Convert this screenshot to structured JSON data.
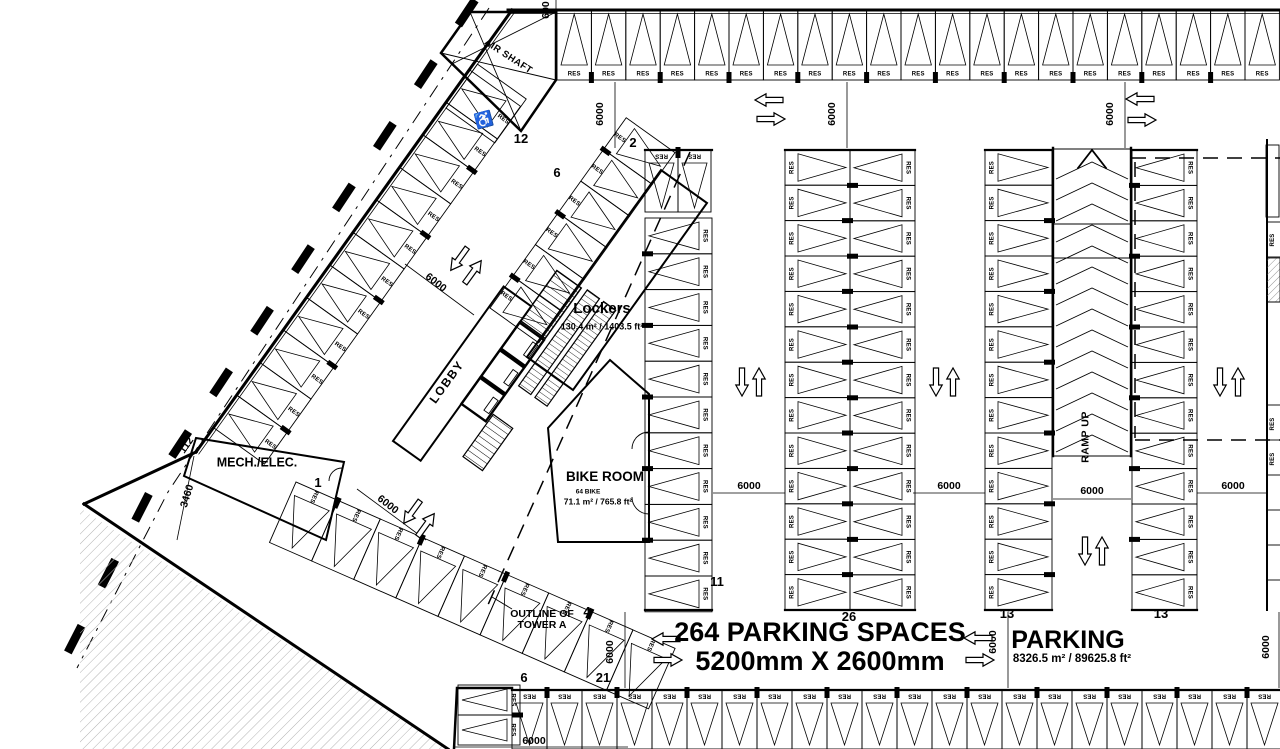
{
  "plan": {
    "labels": {
      "title_line1": "264 PARKING SPACES",
      "title_line2": "5200mm X 2600mm",
      "parking": "PARKING",
      "parking_area": "8326.5 m² / 89625.8 ft²",
      "lobby": "LOBBY",
      "air_shaft": "AIR SHAFT",
      "mech_elec": "MECH./ELEC.",
      "bike_room": "BIKE ROOM",
      "bike_count": "64 BIKE",
      "bike_area": "71.1 m² / 765.8 ft²",
      "lockers": "Lockers",
      "lockers_area": "130.4 m² / 1403.5 ft²",
      "ramp_up": "RAMP UP",
      "outline_line1": "OUTLINE OF",
      "outline_line2": "TOWER A",
      "handicap_icon": "♿"
    },
    "stall_label": "RES",
    "colors": {
      "line": "#000000",
      "background": "#ffffff",
      "hatch": "#b3b3b3"
    },
    "counts": [
      {
        "t": "12",
        "x": 521,
        "y": 143
      },
      {
        "t": "6",
        "x": 557,
        "y": 177
      },
      {
        "t": "2",
        "x": 633,
        "y": 147
      },
      {
        "t": "1",
        "x": 318,
        "y": 487
      },
      {
        "t": "11",
        "x": 717,
        "y": 586
      },
      {
        "t": "26",
        "x": 849,
        "y": 621
      },
      {
        "t": "13",
        "x": 1007,
        "y": 618
      },
      {
        "t": "13",
        "x": 1161,
        "y": 618
      },
      {
        "t": "4",
        "x": 587,
        "y": 616
      },
      {
        "t": "21",
        "x": 603,
        "y": 682
      },
      {
        "t": "6",
        "x": 524,
        "y": 682
      }
    ],
    "dimensions": [
      {
        "t": "600",
        "x": 549,
        "y": 10,
        "r": -90
      },
      {
        "t": "6000",
        "x": 603,
        "y": 114,
        "r": -90
      },
      {
        "t": "6000",
        "x": 835,
        "y": 114,
        "r": -90
      },
      {
        "t": "6000",
        "x": 1113,
        "y": 114,
        "r": -90
      },
      {
        "t": "6000",
        "x": 749,
        "y": 489,
        "r": 0
      },
      {
        "t": "6000",
        "x": 949,
        "y": 489,
        "r": 0
      },
      {
        "t": "6000",
        "x": 1092,
        "y": 494,
        "r": 0
      },
      {
        "t": "6000",
        "x": 1233,
        "y": 489,
        "r": 0
      },
      {
        "t": "6000",
        "x": 613,
        "y": 652,
        "r": -90
      },
      {
        "t": "6000",
        "x": 996,
        "y": 642,
        "r": -90
      },
      {
        "t": "6000",
        "x": 1269,
        "y": 647,
        "r": -90
      },
      {
        "t": "6000",
        "x": 534,
        "y": 744,
        "r": 0
      },
      {
        "t": "6000",
        "x": 434,
        "y": 285,
        "r": 38
      },
      {
        "t": "6000",
        "x": 386,
        "y": 507,
        "r": 38
      },
      {
        "t": "3460",
        "x": 190,
        "y": 497,
        "r": -73
      },
      {
        "t": "112",
        "x": 189,
        "y": 447,
        "r": -55
      }
    ],
    "stall_groups": [
      {
        "id": "top-row",
        "x": 557,
        "y": 10,
        "rot": 0,
        "n": 21,
        "w": 34.4,
        "d": 70,
        "res": "far",
        "tr": 0,
        "blk": "res"
      },
      {
        "id": "bottom-row",
        "x": 512,
        "y": 690,
        "rot": 0,
        "n": 22,
        "w": 35,
        "d": 59,
        "res": "near",
        "tr": 180,
        "blk": "res"
      },
      {
        "id": "bottom-left-pair",
        "x": 520,
        "y": 685,
        "rot": 90,
        "n": 2,
        "w": 30,
        "d": 62,
        "res": "near",
        "tr": 0,
        "blk": "res"
      },
      {
        "id": "colA-top-pair",
        "x": 645,
        "y": 150,
        "rot": 0,
        "n": 2,
        "w": 33,
        "d": 62,
        "res": "near",
        "tr": 180,
        "blk": "res"
      },
      {
        "id": "colA",
        "x": 712,
        "y": 218,
        "rot": 90,
        "n": 11,
        "w": 35.8,
        "d": 67,
        "res": "near",
        "tr": 0,
        "blk": "back"
      },
      {
        "id": "colB-left",
        "x": 785,
        "y": 610,
        "rot": 270,
        "n": 13,
        "w": 35.4,
        "d": 65,
        "res": "near",
        "tr": 0,
        "blk": "back"
      },
      {
        "id": "colB-right",
        "x": 915,
        "y": 150,
        "rot": 90,
        "n": 13,
        "w": 35.4,
        "d": 65,
        "res": "near",
        "tr": 0,
        "blk": "back"
      },
      {
        "id": "colC",
        "x": 985,
        "y": 610,
        "rot": 270,
        "n": 13,
        "w": 35.4,
        "d": 67,
        "res": "near",
        "tr": 0,
        "blk": "back"
      },
      {
        "id": "colD",
        "x": 1197,
        "y": 150,
        "rot": 90,
        "n": 13,
        "w": 35.4,
        "d": 65,
        "res": "near",
        "tr": 0,
        "blk": "back"
      },
      {
        "id": "nw-diagonal",
        "x": 214,
        "y": 428,
        "rot": -54.4,
        "n": 11,
        "w": 40,
        "d": 62,
        "res": "far",
        "tr": 90,
        "blk": "res"
      },
      {
        "id": "sw-diagonal",
        "x": 296,
        "y": 482,
        "rot": 23.7,
        "n": 9,
        "w": 46,
        "d": 66,
        "res": "near",
        "tr": 90,
        "blk": "res"
      },
      {
        "id": "ne-diagonal",
        "x": 490,
        "y": 308,
        "rot": -54.4,
        "n": 6,
        "w": 39,
        "d": 60,
        "res": "near",
        "tr": 90,
        "blk": "res"
      }
    ],
    "edge_res": [
      {
        "x": 1274,
        "y": 240
      },
      {
        "x": 1274,
        "y": 424
      },
      {
        "x": 1274,
        "y": 459
      }
    ],
    "arrows": [
      {
        "x": 769,
        "y": 100,
        "r": 180
      },
      {
        "x": 771,
        "y": 119,
        "r": 0
      },
      {
        "x": 1140,
        "y": 99,
        "r": 180
      },
      {
        "x": 1142,
        "y": 120,
        "r": 0
      },
      {
        "x": 666,
        "y": 639,
        "r": 180
      },
      {
        "x": 668,
        "y": 660,
        "r": 0
      },
      {
        "x": 978,
        "y": 638,
        "r": 180
      },
      {
        "x": 980,
        "y": 660,
        "r": 0
      },
      {
        "x": 742,
        "y": 382,
        "r": 90
      },
      {
        "x": 759,
        "y": 382,
        "r": 270
      },
      {
        "x": 936,
        "y": 382,
        "r": 90
      },
      {
        "x": 953,
        "y": 382,
        "r": 270
      },
      {
        "x": 1220,
        "y": 382,
        "r": 90
      },
      {
        "x": 1238,
        "y": 382,
        "r": 270
      },
      {
        "x": 1085,
        "y": 551,
        "r": 90
      },
      {
        "x": 1102,
        "y": 551,
        "r": 270
      },
      {
        "x": 459,
        "y": 259,
        "r": 126
      },
      {
        "x": 473,
        "y": 272,
        "r": -54
      },
      {
        "x": 412,
        "y": 512,
        "r": 126
      },
      {
        "x": 426,
        "y": 525,
        "r": -54
      }
    ]
  }
}
